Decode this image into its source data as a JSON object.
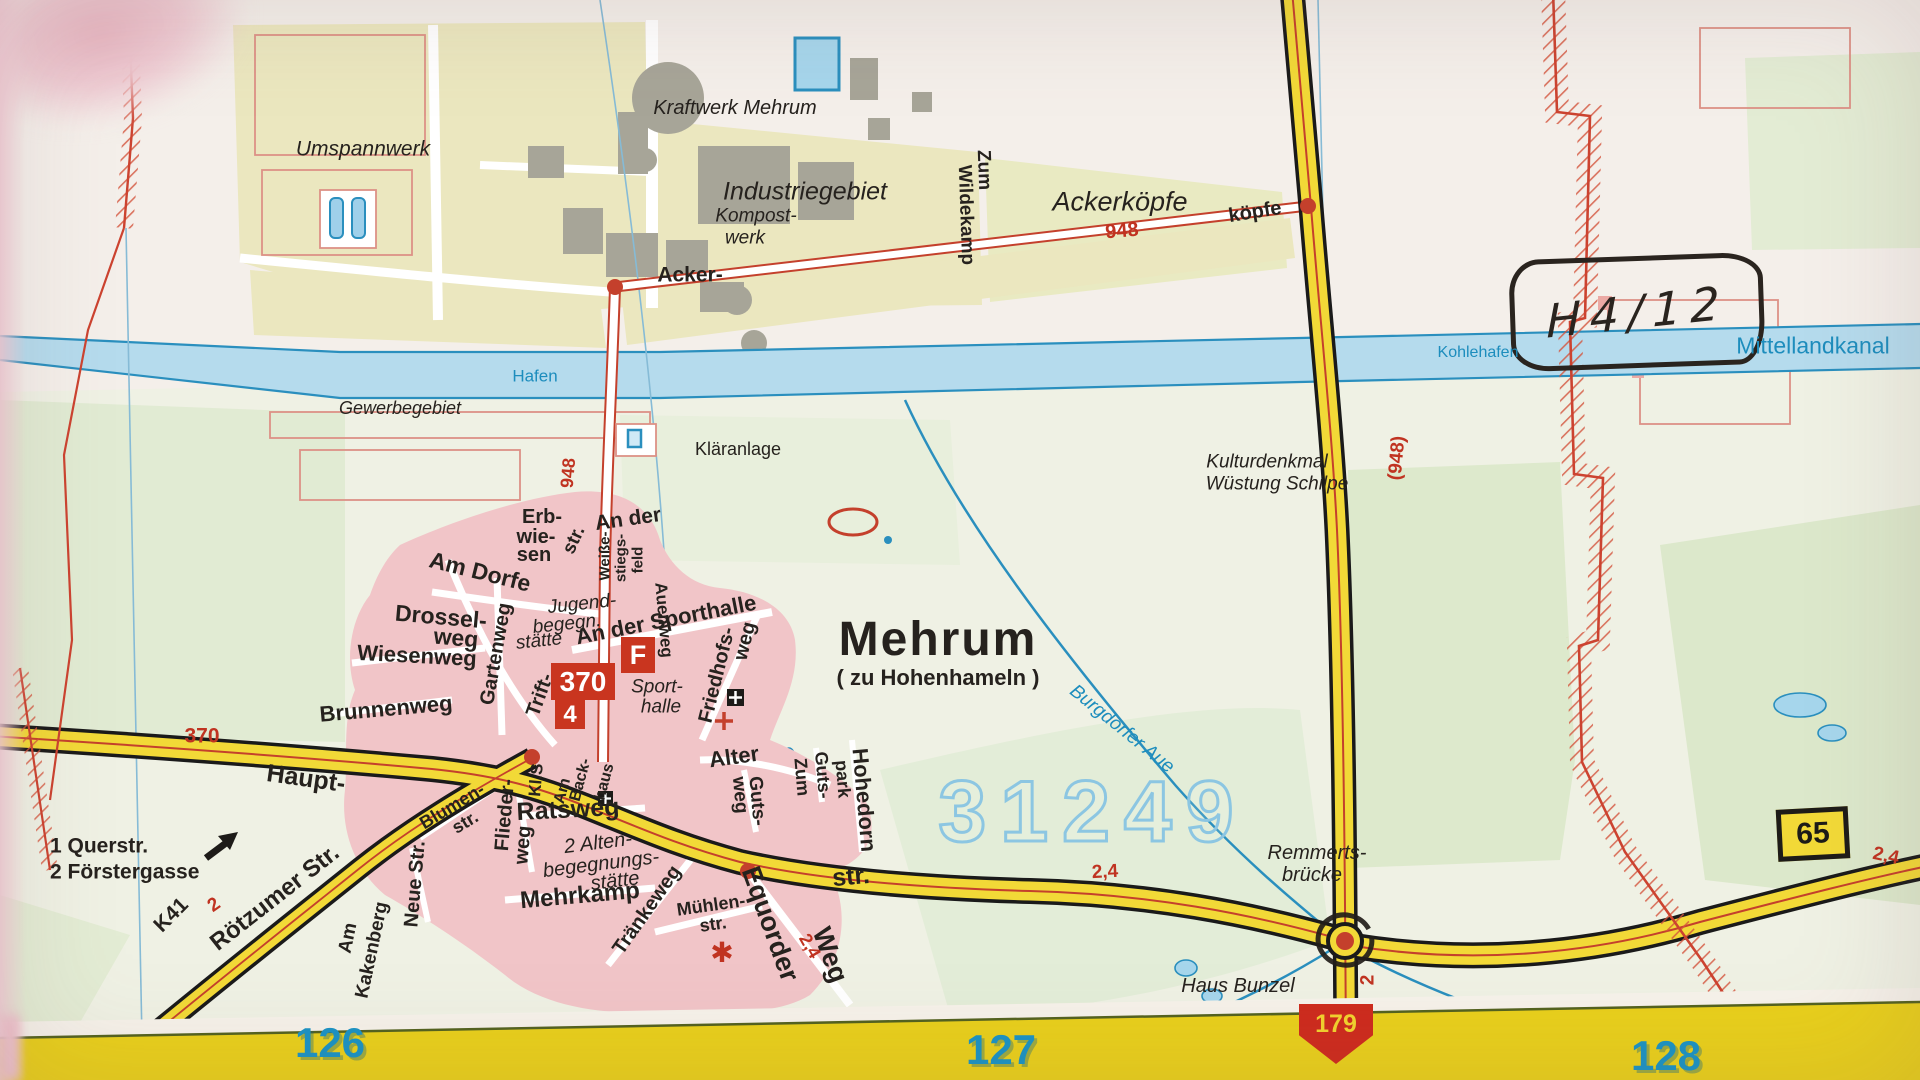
{
  "colors": {
    "k": "#26221e",
    "r": "#c03321",
    "w": "#1d8dbd",
    "g": "#1a93c4"
  },
  "boxes": {
    "route_primary": "370",
    "route_secondary": "4",
    "parking": "F",
    "bundesstrasse": "65",
    "grid_marker": "179"
  },
  "annotation": {
    "text": "H4/12"
  },
  "labels": [
    {
      "n": "umspannwerk-label",
      "t": "Umspannwerk",
      "x": 363,
      "y": 149,
      "s": 21,
      "i": 1,
      "fw": 400
    },
    {
      "n": "kraftwerk-mehrum-label",
      "t": "Kraftwerk Mehrum",
      "x": 735,
      "y": 108,
      "s": 20,
      "i": 1,
      "fw": 400
    },
    {
      "n": "industriegebiet-label",
      "t": "Industriegebiet",
      "x": 805,
      "y": 192,
      "s": 25,
      "i": 1,
      "fw": 400
    },
    {
      "n": "kompostwerk-line1",
      "t": "Kompost-",
      "x": 756,
      "y": 216,
      "s": 19,
      "i": 1,
      "fw": 400
    },
    {
      "n": "kompostwerk-line2",
      "t": "werk",
      "x": 745,
      "y": 238,
      "s": 19,
      "i": 1,
      "fw": 400
    },
    {
      "n": "ackerkoepfe-label",
      "t": "Ackerköpfe",
      "x": 1120,
      "y": 202,
      "s": 27,
      "i": 1,
      "fw": 400
    },
    {
      "n": "zum-wildekamp-line1",
      "t": "Zum",
      "x": 984,
      "y": 170,
      "s": 19,
      "r": 88
    },
    {
      "n": "zum-wildekamp-line2",
      "t": "Wildekamp",
      "x": 966,
      "y": 215,
      "s": 19,
      "r": 88
    },
    {
      "n": "road-948-number-top",
      "t": "948",
      "x": 1122,
      "y": 231,
      "s": 20,
      "c": "r",
      "r": -5
    },
    {
      "n": "koepfe-label",
      "t": "köpfe",
      "x": 1255,
      "y": 212,
      "s": 20,
      "r": -9
    },
    {
      "n": "acker-label",
      "t": "Acker-",
      "x": 690,
      "y": 275,
      "s": 21
    },
    {
      "n": "hafen-label",
      "t": "Hafen",
      "x": 535,
      "y": 376,
      "s": 17,
      "c": "w",
      "fw": 400
    },
    {
      "n": "gewerbegebiet-label",
      "t": "Gewerbegebiet",
      "x": 400,
      "y": 408,
      "s": 18,
      "i": 1,
      "fw": 400
    },
    {
      "n": "kohlehafen-label",
      "t": "Kohlehafen",
      "x": 1478,
      "y": 353,
      "s": 16,
      "c": "w",
      "fw": 400
    },
    {
      "n": "mittellandkanal-label",
      "t": "Mittellandkanal",
      "x": 1813,
      "y": 346,
      "s": 23,
      "c": "w",
      "fw": 400
    },
    {
      "n": "klaeranlage-label",
      "t": "Kläranlage",
      "x": 738,
      "y": 449,
      "s": 18,
      "fw": 400
    },
    {
      "n": "kulturdenkmal-line1",
      "t": "Kulturdenkmal",
      "x": 1267,
      "y": 462,
      "s": 19,
      "i": 1,
      "fw": 400
    },
    {
      "n": "kulturdenkmal-line2",
      "t": "Wüstung Schilpe",
      "x": 1277,
      "y": 484,
      "s": 19,
      "i": 1,
      "fw": 400
    },
    {
      "n": "road-948-bracket",
      "t": "(948)",
      "x": 1397,
      "y": 458,
      "s": 19,
      "c": "r",
      "r": -85
    },
    {
      "n": "road-948-vertical",
      "t": "948",
      "x": 568,
      "y": 473,
      "s": 18,
      "c": "r",
      "r": -85
    },
    {
      "n": "erbwiesen-line1",
      "t": "Erb-",
      "x": 542,
      "y": 517,
      "s": 20
    },
    {
      "n": "erbwiesen-line2",
      "t": "wie-",
      "x": 536,
      "y": 537,
      "s": 20
    },
    {
      "n": "erbwiesen-line3",
      "t": "sen",
      "x": 534,
      "y": 555,
      "s": 20
    },
    {
      "n": "an-der-label",
      "t": "An der",
      "x": 628,
      "y": 519,
      "s": 21,
      "r": -8
    },
    {
      "n": "triftstr-upper-label",
      "t": "str.",
      "x": 574,
      "y": 540,
      "s": 19,
      "r": -65
    },
    {
      "n": "weissestiegsfeld-line1",
      "t": "Weiße-",
      "x": 605,
      "y": 556,
      "s": 15,
      "r": -90
    },
    {
      "n": "weissestiegsfeld-line2",
      "t": "stiegs-",
      "x": 621,
      "y": 558,
      "s": 15,
      "r": -90
    },
    {
      "n": "weissestiegsfeld-line3",
      "t": "feld",
      "x": 638,
      "y": 560,
      "s": 15,
      "r": -90
    },
    {
      "n": "auenweg-label",
      "t": "Auenweg",
      "x": 664,
      "y": 620,
      "s": 17,
      "r": 85
    },
    {
      "n": "am-dorfe-label",
      "t": "Am Dorfe",
      "x": 480,
      "y": 572,
      "s": 23,
      "r": 14
    },
    {
      "n": "drosselweg-line1",
      "t": "Drossel-",
      "x": 441,
      "y": 617,
      "s": 23,
      "r": 5
    },
    {
      "n": "drosselweg-line2",
      "t": "weg",
      "x": 456,
      "y": 638,
      "s": 23,
      "r": 5
    },
    {
      "n": "jugendbegegnungsstaette-line1",
      "t": "Jugend-",
      "x": 582,
      "y": 604,
      "s": 19,
      "i": 1,
      "fw": 400,
      "r": -6
    },
    {
      "n": "jugendbegegnungsstaette-line2",
      "t": "begegn.",
      "x": 567,
      "y": 624,
      "s": 19,
      "i": 1,
      "fw": 400,
      "r": -6
    },
    {
      "n": "jugendbegegnungsstaette-line3",
      "t": "stätte",
      "x": 539,
      "y": 641,
      "s": 19,
      "i": 1,
      "fw": 400,
      "r": -6
    },
    {
      "n": "an-der-sporthalle-label",
      "t": "An der Sporthalle",
      "x": 666,
      "y": 620,
      "s": 22,
      "r": -11
    },
    {
      "n": "wiesenweg-label",
      "t": "Wiesenweg",
      "x": 417,
      "y": 656,
      "s": 22,
      "r": 3
    },
    {
      "n": "gartenweg-label",
      "t": "Gartenweg",
      "x": 496,
      "y": 654,
      "s": 20,
      "r": -80
    },
    {
      "n": "triftstr-label",
      "t": "Trift-",
      "x": 540,
      "y": 695,
      "s": 20,
      "r": -70
    },
    {
      "n": "sporthalle-line1",
      "t": "Sport-",
      "x": 657,
      "y": 687,
      "s": 19,
      "i": 1,
      "fw": 400
    },
    {
      "n": "sporthalle-line2",
      "t": "halle",
      "x": 661,
      "y": 707,
      "s": 19,
      "i": 1,
      "fw": 400
    },
    {
      "n": "friedhofsweg-line1",
      "t": "Friedhofs-",
      "x": 717,
      "y": 675,
      "s": 20,
      "r": -76
    },
    {
      "n": "friedhofsweg-line2",
      "t": "weg",
      "x": 745,
      "y": 641,
      "s": 20,
      "r": -76
    },
    {
      "n": "brunnenweg-label",
      "t": "Brunnenweg",
      "x": 386,
      "y": 709,
      "s": 22,
      "r": -5
    },
    {
      "n": "mehrum-label",
      "t": "Mehrum",
      "x": 938,
      "y": 640,
      "s": 48,
      "sp": 2
    },
    {
      "n": "zu-hohenhameln-label",
      "t": "( zu Hohenhameln )",
      "x": 938,
      "y": 678,
      "s": 22
    },
    {
      "n": "route-370-left-label",
      "t": "370",
      "x": 202,
      "y": 736,
      "s": 21,
      "c": "r"
    },
    {
      "n": "hauptstr-label",
      "t": "Haupt-",
      "x": 306,
      "y": 779,
      "s": 25,
      "r": 8
    },
    {
      "n": "legend-querstr",
      "t": "1 Querstr.",
      "x": 50,
      "y": 846,
      "s": 21,
      "a": "l"
    },
    {
      "n": "legend-foerstergasse",
      "t": "2 Förstergasse",
      "x": 50,
      "y": 872,
      "s": 21,
      "a": "l"
    },
    {
      "n": "k41-label",
      "t": "K41",
      "x": 171,
      "y": 915,
      "s": 21,
      "r": -45
    },
    {
      "n": "k41-km-label",
      "t": "2",
      "x": 214,
      "y": 905,
      "s": 19,
      "c": "r",
      "r": -35
    },
    {
      "n": "roetzumer-str-label",
      "t": "Rötzumer Str.",
      "x": 275,
      "y": 898,
      "s": 24,
      "r": -38
    },
    {
      "n": "am-kakenberg-line1",
      "t": "Am",
      "x": 348,
      "y": 938,
      "s": 19,
      "r": -78
    },
    {
      "n": "am-kakenberg-line2",
      "t": "Kakenberg",
      "x": 372,
      "y": 950,
      "s": 19,
      "r": -78
    },
    {
      "n": "neue-str-label",
      "t": "Neue Str.",
      "x": 415,
      "y": 884,
      "s": 20,
      "r": -85
    },
    {
      "n": "blumenstr-line1",
      "t": "Blumen-",
      "x": 452,
      "y": 806,
      "s": 18,
      "r": -31
    },
    {
      "n": "blumenstr-line2",
      "t": "str.",
      "x": 465,
      "y": 822,
      "s": 18,
      "r": -31
    },
    {
      "n": "fliederweg-line1",
      "t": "Flieder-",
      "x": 505,
      "y": 815,
      "s": 20,
      "r": -85
    },
    {
      "n": "fliederweg-line2",
      "t": "weg",
      "x": 523,
      "y": 845,
      "s": 20,
      "r": -85
    },
    {
      "n": "kl-str-label",
      "t": "Kl.S",
      "x": 536,
      "y": 780,
      "s": 17,
      "r": -85
    },
    {
      "n": "am-backhaus-line1",
      "t": "Am",
      "x": 563,
      "y": 791,
      "s": 16,
      "r": -75
    },
    {
      "n": "am-backhaus-line2",
      "t": "Back-",
      "x": 581,
      "y": 780,
      "s": 16,
      "r": -75
    },
    {
      "n": "am-backhaus-line3",
      "t": "haus",
      "x": 605,
      "y": 782,
      "s": 16,
      "r": -75
    },
    {
      "n": "ratsweg-label",
      "t": "Ratsweg",
      "x": 568,
      "y": 810,
      "s": 25,
      "r": -3
    },
    {
      "n": "altenbegegnungsstaette-line1",
      "t": "2 Alten-",
      "x": 598,
      "y": 843,
      "s": 20,
      "i": 1,
      "fw": 400,
      "r": -7
    },
    {
      "n": "altenbegegnungsstaette-line2",
      "t": "begegnungs-",
      "x": 601,
      "y": 864,
      "s": 20,
      "i": 1,
      "fw": 400,
      "r": -7
    },
    {
      "n": "altenbegegnungsstaette-line3",
      "t": "stätte",
      "x": 615,
      "y": 881,
      "s": 20,
      "i": 1,
      "fw": 400,
      "r": -7
    },
    {
      "n": "mehrkamp-label",
      "t": "Mehrkamp",
      "x": 580,
      "y": 896,
      "s": 24,
      "r": -5
    },
    {
      "n": "traenkeweg-label",
      "t": "Tränkeweg",
      "x": 647,
      "y": 910,
      "s": 20,
      "r": -55
    },
    {
      "n": "muehlenstr-line1",
      "t": "Mühlen-",
      "x": 711,
      "y": 905,
      "s": 18,
      "r": -8
    },
    {
      "n": "muehlenstr-line2",
      "t": "str.",
      "x": 713,
      "y": 924,
      "s": 18,
      "r": -8
    },
    {
      "n": "equorder-weg-line1",
      "t": "Equorder",
      "x": 770,
      "y": 924,
      "s": 27,
      "r": 70
    },
    {
      "n": "equorder-weg-line2",
      "t": "Weg",
      "x": 830,
      "y": 955,
      "s": 27,
      "r": 70
    },
    {
      "n": "equorder-km-label",
      "t": "2,4",
      "x": 810,
      "y": 946,
      "s": 18,
      "c": "r",
      "r": 60
    },
    {
      "n": "windmill-symbol",
      "t": "✱",
      "x": 722,
      "y": 953,
      "s": 28,
      "c": "r",
      "fw": 400
    },
    {
      "n": "gutsweg-line1",
      "t": "Guts-",
      "x": 757,
      "y": 801,
      "s": 19,
      "r": 85
    },
    {
      "n": "gutsweg-line2",
      "t": "weg",
      "x": 740,
      "y": 795,
      "s": 19,
      "r": 85
    },
    {
      "n": "zum-gutspark-line1",
      "t": "Zum",
      "x": 802,
      "y": 777,
      "s": 18,
      "r": 85
    },
    {
      "n": "zum-gutspark-line2",
      "t": "Guts-",
      "x": 823,
      "y": 775,
      "s": 18,
      "r": 85
    },
    {
      "n": "zum-gutspark-line3",
      "t": "park",
      "x": 843,
      "y": 779,
      "s": 18,
      "r": 85
    },
    {
      "n": "hohedorn-label",
      "t": "Hohedorn",
      "x": 864,
      "y": 800,
      "s": 22,
      "r": 85
    },
    {
      "n": "alter-label",
      "t": "Alter",
      "x": 734,
      "y": 757,
      "s": 22,
      "r": -8
    },
    {
      "n": "str-main-label",
      "t": "str.",
      "x": 851,
      "y": 877,
      "s": 25,
      "r": -5
    },
    {
      "n": "km-24-main-label",
      "t": "2,4",
      "x": 1105,
      "y": 872,
      "s": 19,
      "c": "r",
      "r": -3
    },
    {
      "n": "postal-code-label",
      "t": "31249",
      "x": 1093,
      "y": 812,
      "s": 86,
      "cls": "plz"
    },
    {
      "n": "burgdorfer-aue-label",
      "t": "Burgdorfer Aue",
      "x": 1122,
      "y": 729,
      "s": 19,
      "c": "w",
      "i": 1,
      "fw": 400,
      "r": 39
    },
    {
      "n": "remmertsbruecke-line1",
      "t": "Remmerts-",
      "x": 1317,
      "y": 853,
      "s": 20,
      "i": 1,
      "fw": 400
    },
    {
      "n": "remmertsbruecke-line2",
      "t": "brücke",
      "x": 1312,
      "y": 875,
      "s": 20,
      "i": 1,
      "fw": 400
    },
    {
      "n": "haus-bunzel-label",
      "t": "Haus Bunzel",
      "x": 1238,
      "y": 986,
      "s": 20,
      "i": 1,
      "fw": 400
    },
    {
      "n": "km-24-right-label",
      "t": "2,4",
      "x": 1886,
      "y": 856,
      "s": 19,
      "c": "r",
      "r": 12
    },
    {
      "n": "km-2-roundabout-label",
      "t": "2",
      "x": 1368,
      "y": 980,
      "s": 19,
      "c": "r",
      "r": -90
    },
    {
      "n": "grid-number-126",
      "t": "126",
      "x": 330,
      "y": 1043,
      "s": 42,
      "c": "g",
      "cls": "grid-num"
    },
    {
      "n": "grid-number-127",
      "t": "127",
      "x": 1001,
      "y": 1050,
      "s": 42,
      "c": "g",
      "cls": "grid-num"
    },
    {
      "n": "grid-number-128",
      "t": "128",
      "x": 1666,
      "y": 1056,
      "s": 42,
      "c": "g",
      "cls": "grid-num"
    }
  ]
}
